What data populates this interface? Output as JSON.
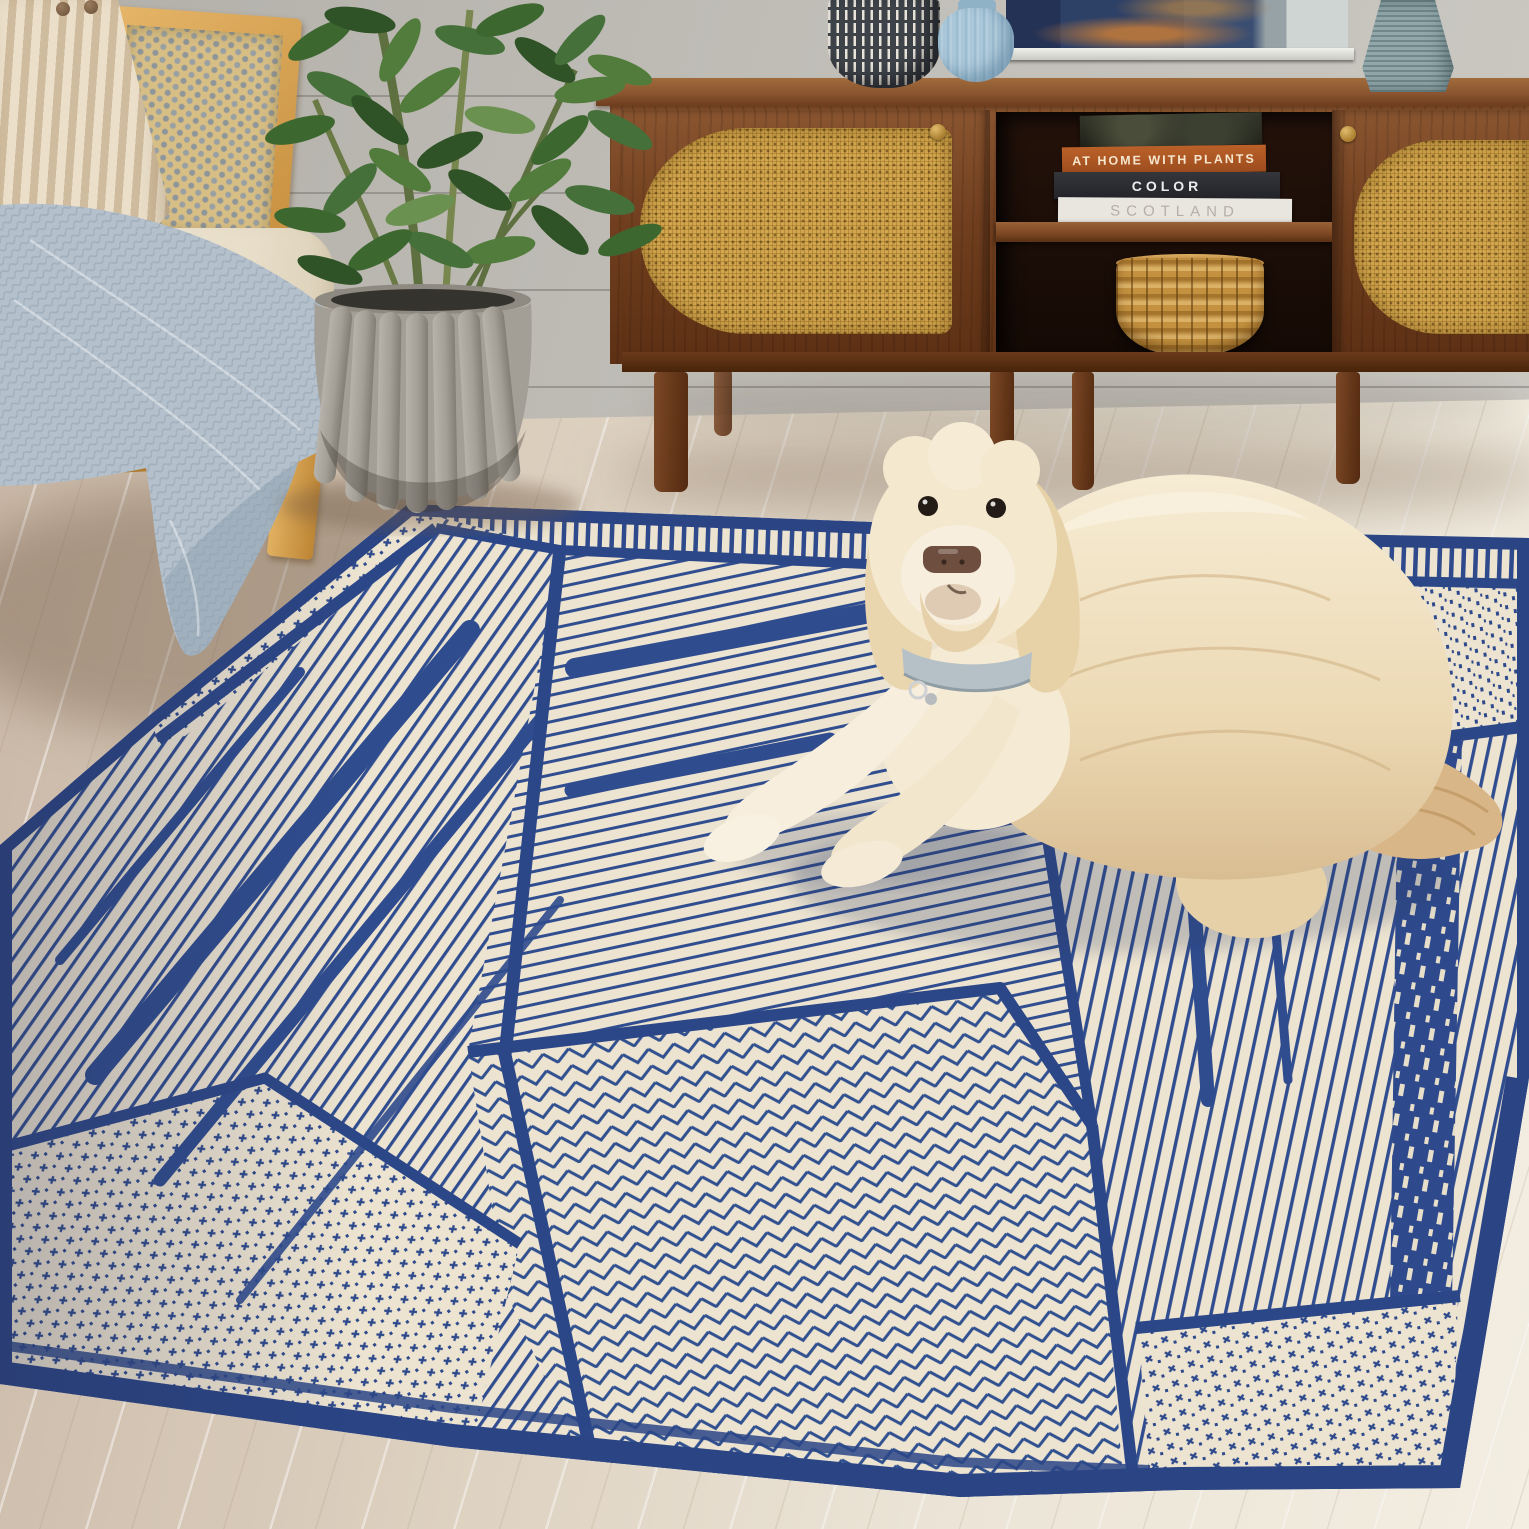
{
  "scene": {
    "setting": "Living-room product photo: a cream doodle dog lying on a navy-and-ivory geometric patchwork wool rug",
    "wall": "gray shiplap planks",
    "floor": "whitewashed diagonal wood planks",
    "objects": [
      "cane-back oak armchair",
      "striped lumbar pillow",
      "chunky knit throw blanket",
      "fluted gray stone planter",
      "green houseplant",
      "walnut media console with cane sliding doors",
      "framed abstract navy artwork",
      "black-and-white dash vase",
      "light blue ribbed vase",
      "gray-teal ribbed vase",
      "stack of design books",
      "woven water-hyacinth basket",
      "cream shaggy dog with light blue collar",
      "navy and ivory patchwork area rug"
    ]
  },
  "console": {
    "material": "walnut, cane door panels, brass knobs",
    "books": [
      {
        "title": "AT HOME WITH PLANTS",
        "spine_color": "#AD5A26",
        "text_color": "#F5E6CD"
      },
      {
        "title": "COLOR",
        "spine_color": "#2C2E33",
        "text_color": "#ECECEC"
      },
      {
        "title": "SCOTLAND",
        "spine_color": "#E9E6DF",
        "text_color": "#B5B0A7"
      }
    ]
  },
  "rug": {
    "field_color": "#ECE3D0",
    "navy_color": "#2E4A8C",
    "patterns": [
      "fine pinstripes at varied angles",
      "herringbone",
      "cross-stitch dashes",
      "speckle dots",
      "fringe bars",
      "solid navy bands"
    ]
  },
  "dog": {
    "look": "cream goldendoodle, dark eyes, brown nose, tan tail",
    "collar_color": "#B6C1C7"
  },
  "palette": {
    "wall": "#C2BFB9",
    "floor": "#EBE4D6",
    "walnut": "#713F1F",
    "cane": "#D2A74E",
    "oak": "#D9A856",
    "blanket": "#B4C0CB",
    "pot": "#A39F96",
    "plant": "#3C672F",
    "basket": "#C3913F",
    "art_navy": "#2D4066",
    "vase_blue": "#A9C7D8",
    "vase_teal": "#839A9D"
  }
}
